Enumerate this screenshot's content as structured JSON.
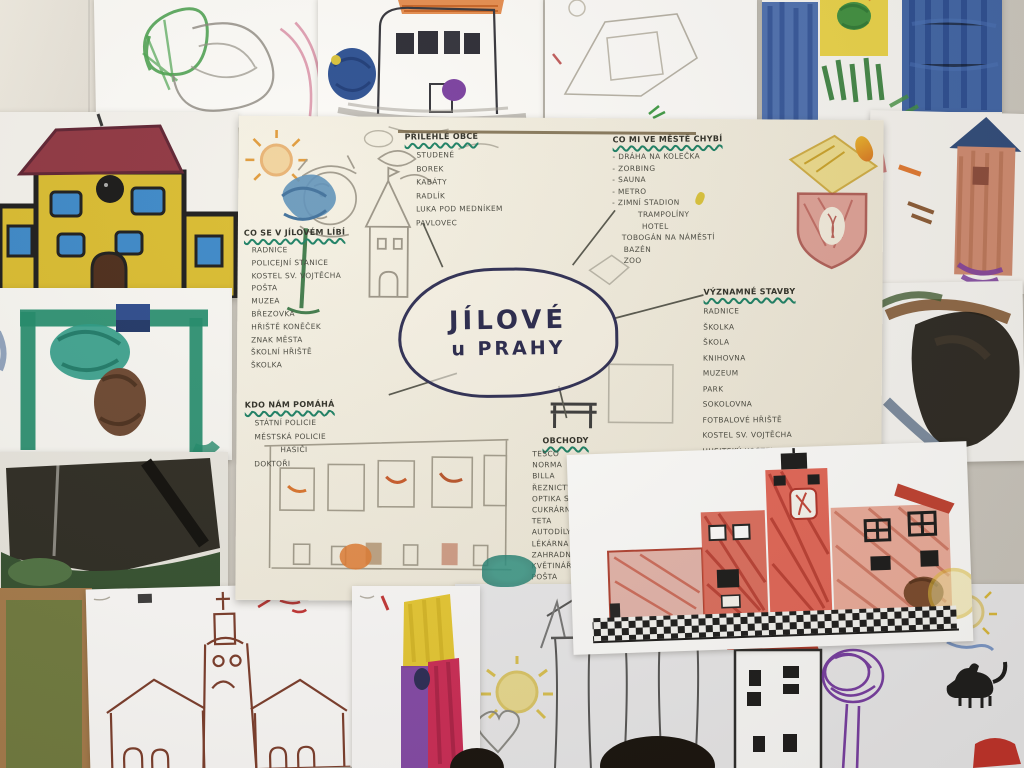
{
  "mindmap": {
    "center": {
      "line1": "JÍLOVÉ",
      "line2": "u PRAHY"
    },
    "groups": {
      "likes": {
        "title": "CO SE V JÍLOVÉM LÍBÍ",
        "items": [
          "RADNICE",
          "POLICEJNÍ STANICE",
          "KOSTEL SV. VOJTĚCHA",
          "POŠTA",
          "MUZEA",
          "BŘEZOVKA",
          "HŘIŠTĚ KONĚČEK",
          "ZNAK MĚSTA",
          "ŠKOLNÍ HŘIŠTĚ",
          "ŠKOLKA"
        ]
      },
      "villages": {
        "title": "PŘILEHLÉ OBCE",
        "items": [
          "STUDENÉ",
          "BOREK",
          "KABÁTY",
          "RADLÍK",
          "LUKA POD MEDNÍKEM",
          "PAVLOVEC"
        ]
      },
      "missing": {
        "title": "CO MI VE MĚSTĚ CHYBÍ",
        "items": [
          "- DRÁHA NA KOLEČKA",
          "- ZORBING",
          "- SAUNA",
          "- METRO",
          "- ZIMNÍ STADION",
          "TRAMPOLÍNY",
          "HOTEL",
          "TOBOGÁN NA NÁMĚSTÍ",
          "BAZÉN",
          "ZOO"
        ]
      },
      "buildings": {
        "title": "VÝZNAMNÉ STAVBY",
        "items": [
          "RADNICE",
          "ŠKOLKA",
          "ŠKOLA",
          "KNIHOVNA",
          "MUZEUM",
          "PARK",
          "SOKOLOVNA",
          "FOTBALOVÉ HŘIŠTĚ",
          "KOSTEL SV. VOJTĚCHA",
          "HUSITSKÝ KOSTEL"
        ]
      },
      "helpers": {
        "title": "KDO NÁM POMÁHÁ",
        "items": [
          "STÁTNÍ POLICIE",
          "MĚSTSKÁ POLICIE",
          "HASIČI",
          "DOKTOŘI"
        ]
      },
      "shops": {
        "title": "OBCHODY",
        "items_left": [
          "TESCO",
          "NORMA",
          "BILLA",
          "ŘEZNICTVÍ",
          "OPTIKA S BRÝLEMI",
          "CUKRÁRNA",
          "TETA",
          "AUTODÍLY",
          "LÉKÁRNA",
          "ZAHRADNICTVÍ",
          "KVĚTINÁŘSTVÍ",
          "POŠTA"
        ],
        "items_right": [
          "DROGERIE",
          "ČESKÁ SPOŘITELNA",
          "RESTAURACE"
        ]
      }
    }
  },
  "drawings": {
    "top_left_scribble": "green and grey crayon scribble with pink arcs",
    "ink_house": "ink house, orange roof, blue and purple blobs",
    "faint_pencil_sketch": "faint pencil shapes",
    "blue_crayon_field": "blue crayon, yellow window, green grass",
    "orange_tower": "orange tower with dark blue roof",
    "dark_watercolor": "black and brown watercolor",
    "yellow_house_painting": "yellow house, red roof, blue windows, clock",
    "green_frame_painting": "green frame, teal and brown blobs",
    "dark_green_painting": "dark green landscape",
    "corkboard": "green board with wooden frame",
    "church_drawing": "brown pen church with cross",
    "color_tower_drawing": "yellow, purple and red tower",
    "bottom_sketch_sheet": "sun, heart, zigzag, fence, white tower, purple tree, cat",
    "red_town_hall": "red marker town hall with checkered base",
    "town_crest": "yellow ribbon and red shield coat of arms",
    "shop_street_sketch": "pencil shop fronts with orange details",
    "blue_tree": "blue watercolor tree",
    "castle_sketch": "pencil castle tower",
    "sun_scribble": "orange sun",
    "face_profile": "pencil face profile"
  },
  "colors": {
    "wall": "#d2cec6",
    "poster": "#f2eddf",
    "ink": "#2c2c52",
    "underline_green": "#1a7f63",
    "handwriting": "#46463d",
    "red_marker": "#d85a48",
    "yellow_paint": "#d9bb2e"
  }
}
